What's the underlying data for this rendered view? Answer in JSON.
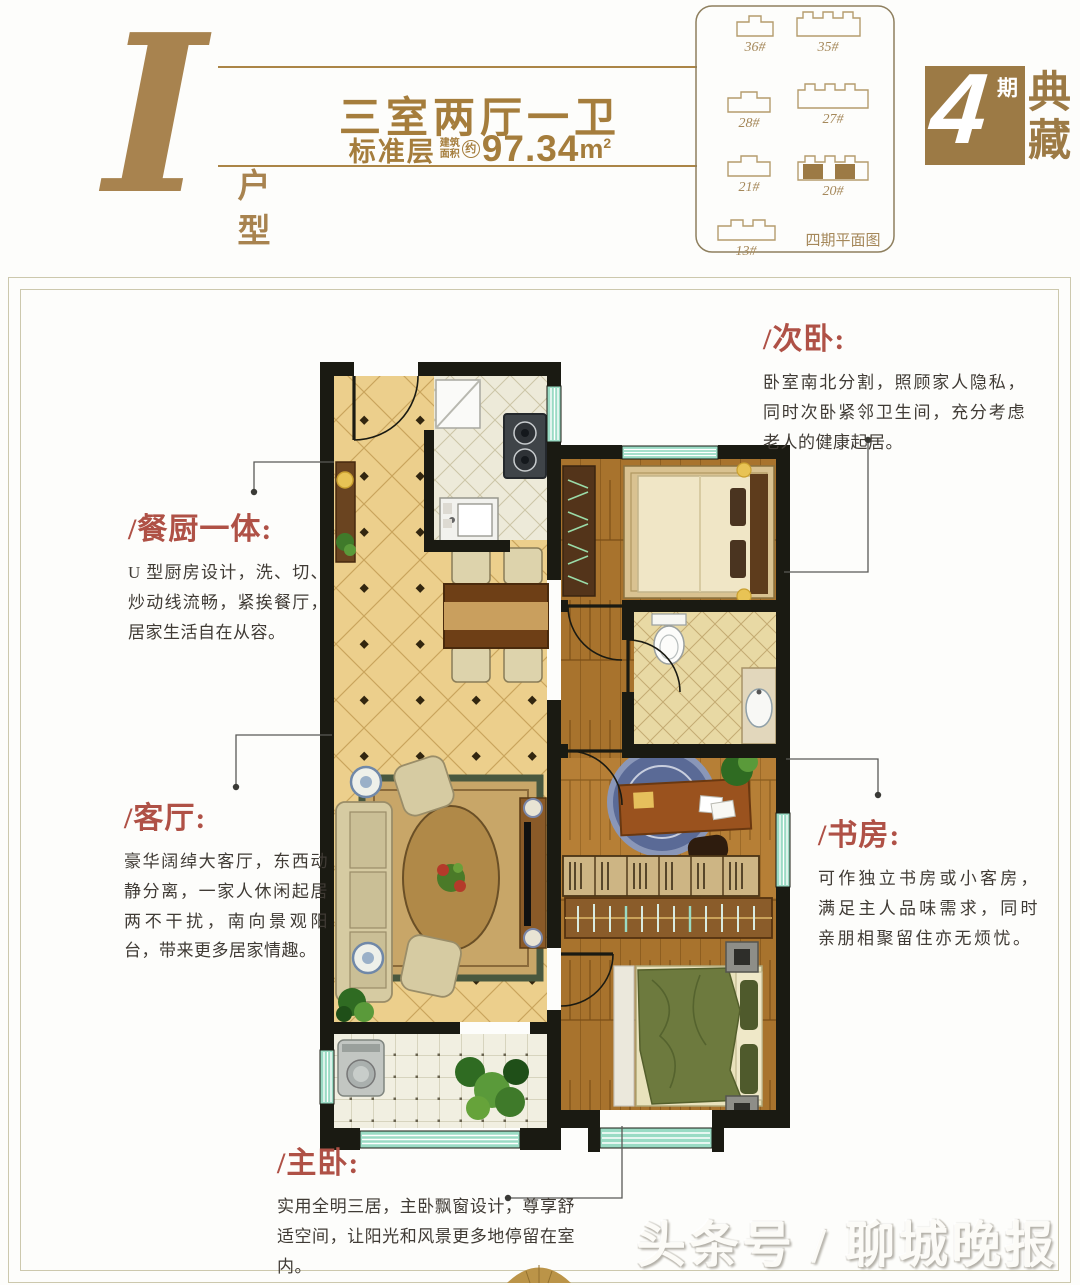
{
  "header": {
    "letter": "I",
    "type_label": "户型",
    "title": "三室两厅一卫",
    "floor_label": "标准层",
    "area_note_top": "建筑",
    "area_note_bottom": "面积",
    "area_approx": "约",
    "area_value": "97.34",
    "area_unit": "m",
    "area_unit_sup": "2"
  },
  "logo": {
    "number": "4",
    "phase": "期",
    "top_char": "典",
    "bottom_char": "藏"
  },
  "siteplan": {
    "caption": "四期平面图",
    "buildings": [
      "36#",
      "35#",
      "28#",
      "27#",
      "21#",
      "20#",
      "13#"
    ]
  },
  "annotations": {
    "ciwo": {
      "title": "/次卧:",
      "body": "卧室南北分割，照顾家人隐私，同时次卧紧邻卫生间，充分考虑老人的健康起居。"
    },
    "canchu": {
      "title": "/餐厨一体:",
      "body": "U 型厨房设计，洗、切、炒动线流畅，紧挨餐厅，居家生活自在从容。"
    },
    "keting": {
      "title": "/客厅:",
      "body": "豪华阔绰大客厅，东西动静分离，一家人休闲起居两不干扰，南向景观阳台，带来更多居家情趣。"
    },
    "shufang": {
      "title": "/书房:",
      "body": "可作独立书房或小客房，满足主人品味需求，同时亲朋相聚留住亦无烦忧。"
    },
    "zhuwo": {
      "title": "/主卧:",
      "body": "实用全明三居，主卧飘窗设计，尊享舒适空间，让阳光和风景更多地停留在室内。"
    }
  },
  "watermark": "头条号 / 聊城晚报",
  "colors": {
    "gold": "#a8834f",
    "red": "#af5146",
    "wall": "#1a1a12",
    "window": "#9adbc4"
  }
}
